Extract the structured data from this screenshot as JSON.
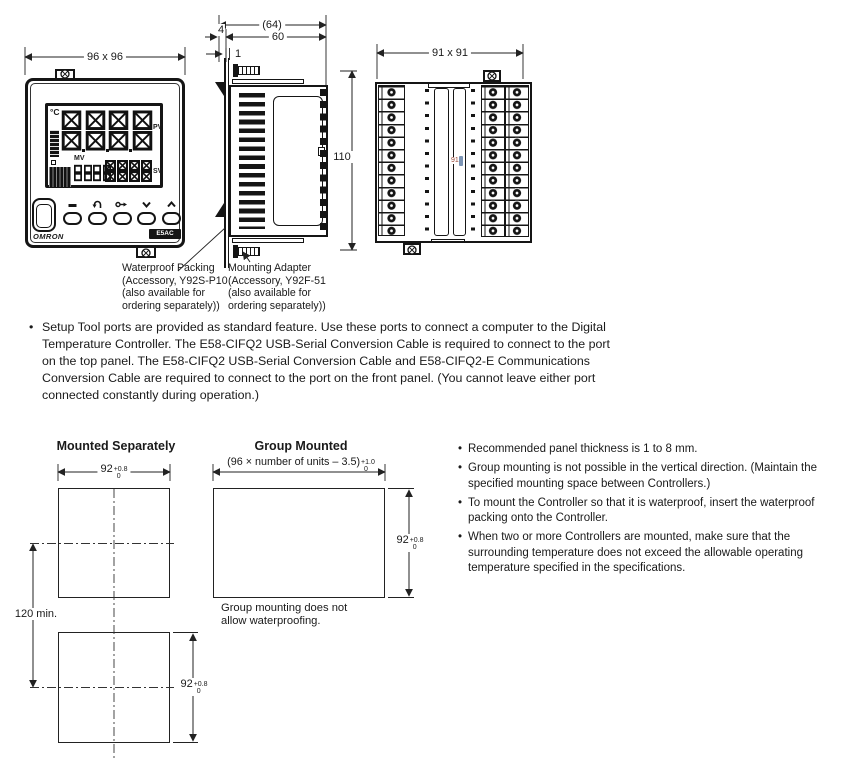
{
  "page": {
    "background": "#ffffff",
    "ink": "#1a1a1a"
  },
  "views": {
    "front": {
      "dim_width": "96 x 96",
      "unit_indicator": "°C",
      "pv_label": "PV",
      "sv_label": "SV",
      "mv_label": "MV",
      "brand": "OMRON",
      "model": "E5AC"
    },
    "side": {
      "dim_total_depth": "(64)",
      "dim_panel_depth": "60",
      "dim_bezel": "4",
      "dim_packing": "1",
      "dim_height": "110"
    },
    "rear": {
      "dim": "91 x 91",
      "inner_ref": "91"
    },
    "callouts": {
      "waterproof_packing": "Waterproof Packing\n(Accessory, Y92S-P10\n(also available for\nordering separately))",
      "mounting_adapter": "Mounting Adapter\n(Accessory, Y92F-51\n(also available for\nordering separately))"
    }
  },
  "setup_note": "Setup Tool ports are provided as standard feature. Use these ports to connect a computer to the Digital Temperature Controller. The E58-CIFQ2 USB-Serial Conversion Cable is required to connect to the port on the top panel. The E58-CIFQ2 USB-Serial Conversion Cable and E58-CIFQ2-E Communications Conversion Cable are required to connect to the port on the front panel. (You cannot leave either port connected constantly during operation.)",
  "mounting": {
    "separate": {
      "title": "Mounted Separately",
      "vertical_pitch": "120 min."
    },
    "group": {
      "title": "Group Mounted",
      "formula_base": "(96 × number of units – 3.5)",
      "formula_sup": "+1.0",
      "formula_sub": "0",
      "note": "Group mounting does not\nallow waterproofing."
    },
    "cutout_92": {
      "base": "92",
      "sup": "+0.8",
      "sub": "0"
    },
    "notes": [
      "Recommended panel thickness is 1 to 8 mm.",
      "Group mounting is not possible in the vertical direction. (Maintain the specified mounting space between Controllers.)",
      "To mount the Controller so that it is waterproof, insert the waterproof packing onto the Controller.",
      "When two or more Controllers are mounted, make sure that the surrounding temperature does not exceed the allowable operating temperature specified in the specifications."
    ]
  }
}
